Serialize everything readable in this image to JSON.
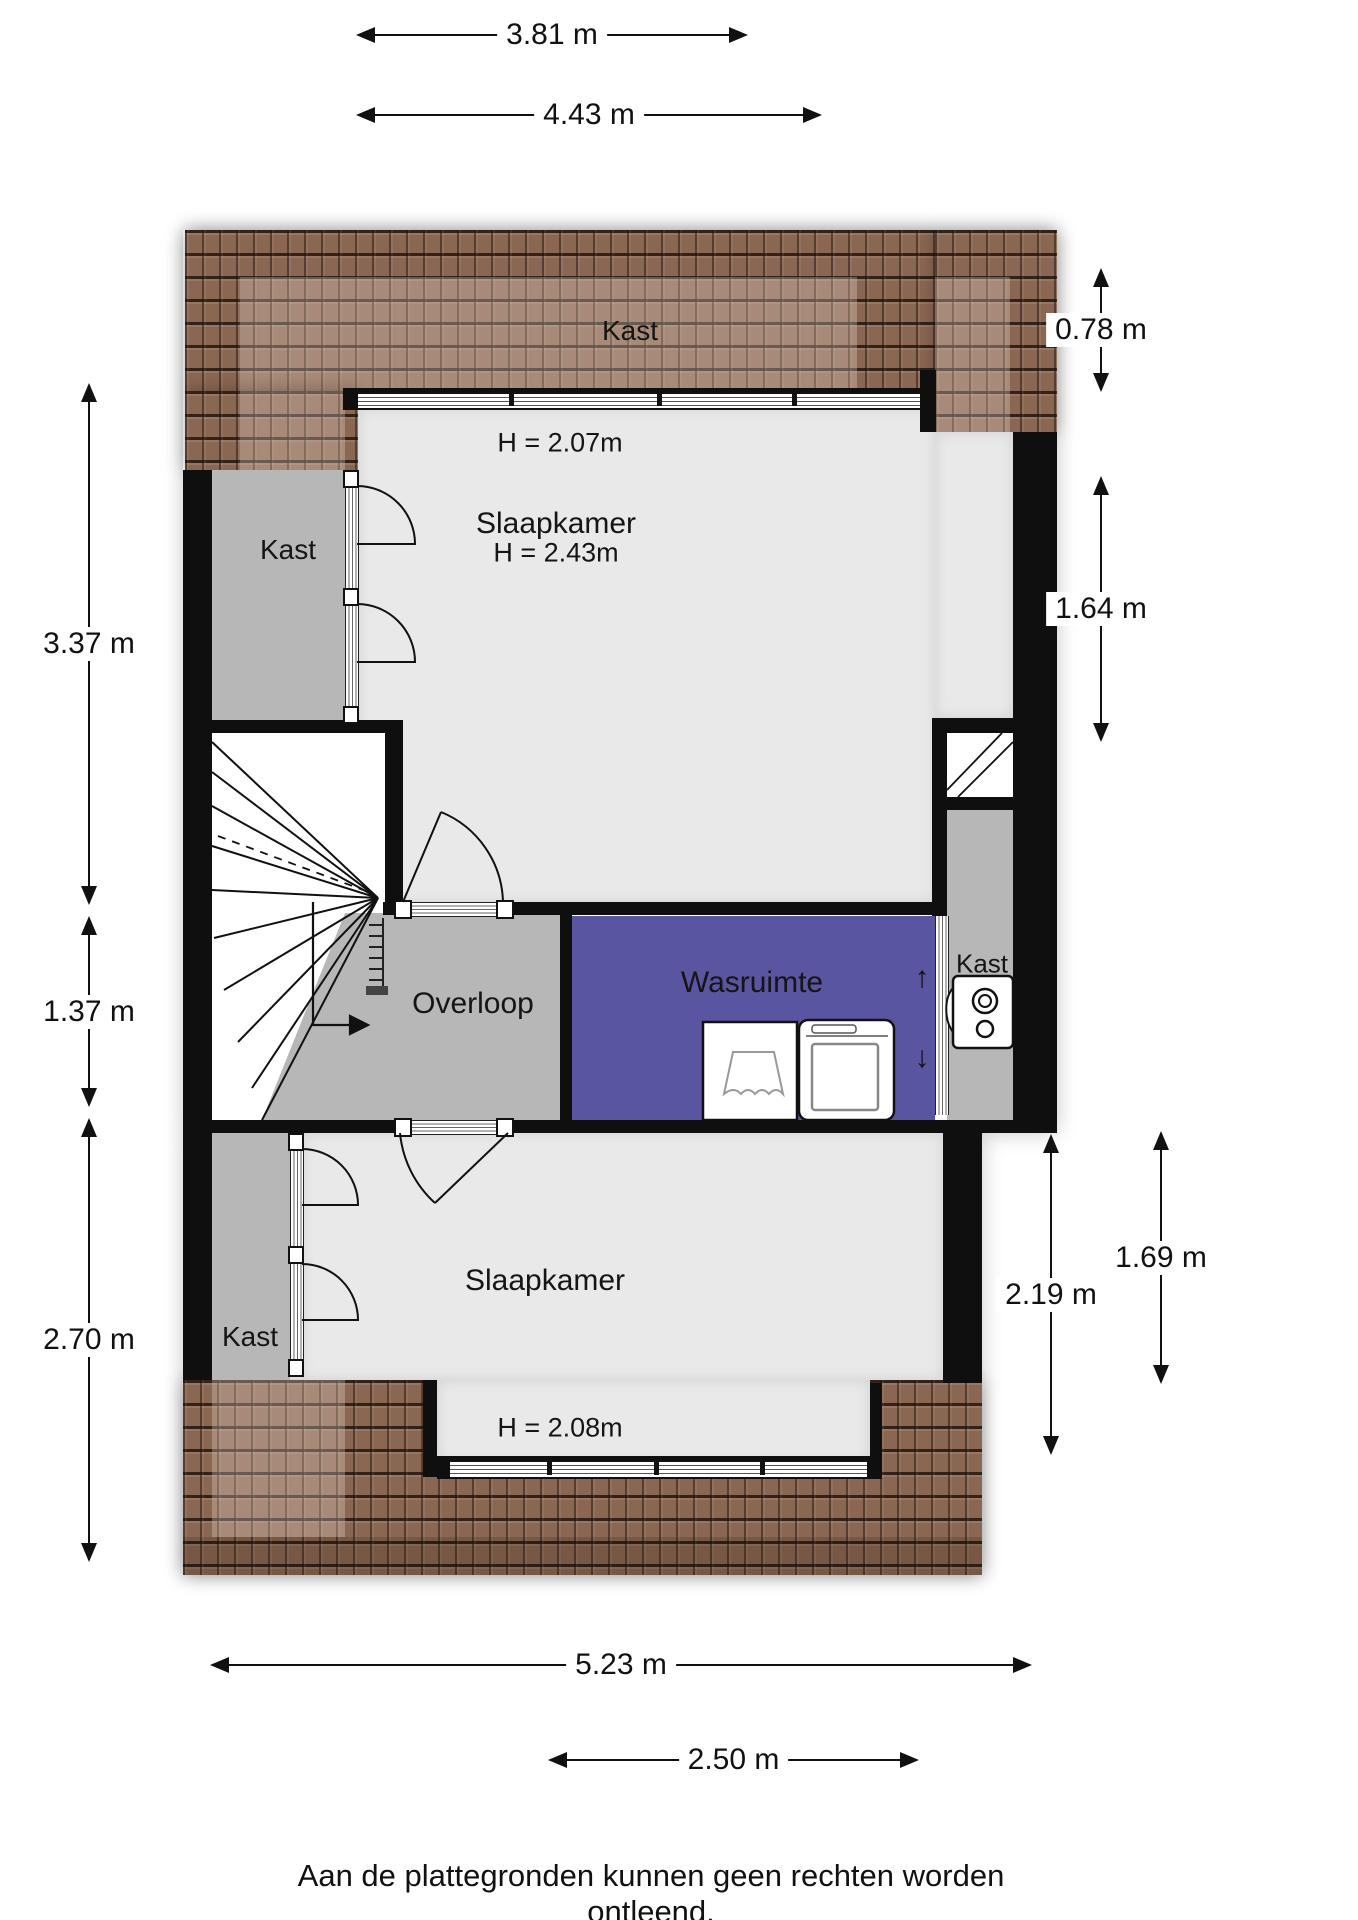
{
  "meta": {
    "type": "floorplan",
    "floor": "attic / tweede verdieping"
  },
  "rooms": {
    "kast_top": "Kast",
    "kast_left": "Kast",
    "kast_right": "Kast",
    "kast_bottom": "Kast",
    "slaapkamer_top": "Slaapkamer",
    "slaapkamer_bottom": "Slaapkamer",
    "overloop": "Overloop",
    "wasruimte": "Wasruimte",
    "height_kast_top": "H = 2.07m",
    "height_slaapkamer_top": "H = 2.43m",
    "height_slaapkamer_bottom": "H = 2.08m"
  },
  "dimensions": {
    "top": [
      {
        "label": "3.81 m"
      },
      {
        "label": "4.43 m"
      }
    ],
    "left": [
      {
        "label": "3.37 m"
      },
      {
        "label": "1.37 m"
      },
      {
        "label": "2.70 m"
      }
    ],
    "right": [
      {
        "label": "0.78 m"
      },
      {
        "label": "1.64 m"
      },
      {
        "label": "2.19 m"
      },
      {
        "label": "1.69 m"
      }
    ],
    "bottom": [
      {
        "label": "5.23 m"
      },
      {
        "label": "2.50 m"
      }
    ]
  },
  "wasruimte_arrows": {
    "up": "↑",
    "down": "↓"
  },
  "icons": [
    "washing-machine-icon",
    "dryer-icon",
    "ventilation-unit-icon",
    "skylight-icon",
    "stairs-icon",
    "door-arc-icon"
  ],
  "colors": {
    "wall": "#0f0f0f",
    "floor_light": "#e9e9ea",
    "floor_dark": "#b7b7b7",
    "wasruimte_purple": "#5a55a0",
    "roof_brown": "#8a6752",
    "dimension_text": "#111111"
  },
  "disclaimer": "Aan de plattegronden kunnen geen rechten worden ontleend."
}
